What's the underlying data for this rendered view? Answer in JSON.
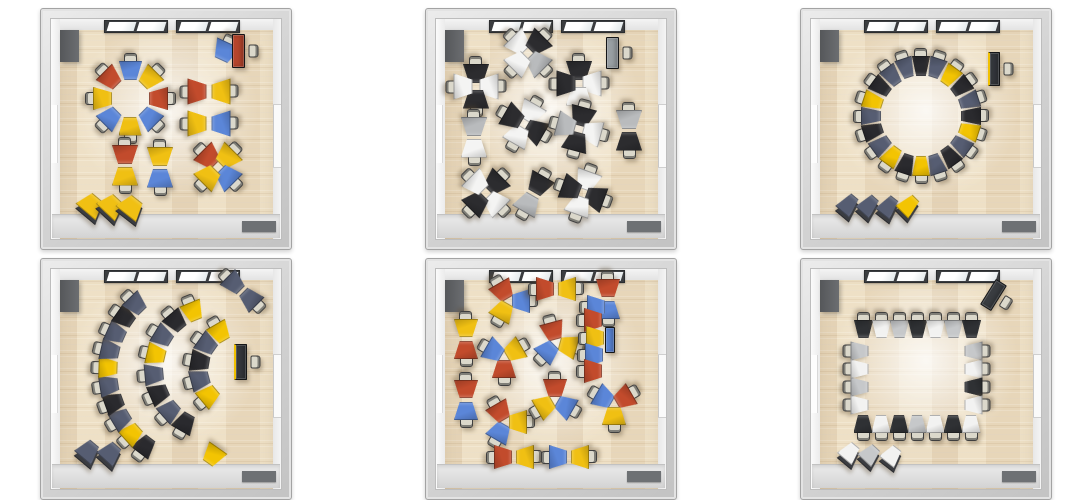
{
  "theme": {
    "floor_wood": "#ecdfc6",
    "wall_gray": "#d2d2d2",
    "walkway_gray": "#dedede",
    "door_mat_gray": "#6e7174",
    "window_frame": "#3b3d40",
    "chair_seat": "#dbd8cb"
  },
  "rooms": [
    {
      "name": "ring-and-groups-color",
      "palette": [
        "#c24b2c",
        "#f0c013",
        "#5b86d8"
      ],
      "tw": 26,
      "th": 19,
      "groups": [
        {
          "t": "ring",
          "cx": 89,
          "cy": 89,
          "r": 28,
          "start": 0,
          "tw": 23,
          "colors": [
            2,
            1,
            0,
            2,
            1,
            2,
            1,
            0
          ]
        },
        {
          "t": "single",
          "x": 184,
          "y": 42,
          "rot": 205,
          "c": 2,
          "chair": true
        },
        {
          "t": "desk",
          "x": 197,
          "y": 42,
          "w": 13,
          "h": 34,
          "rot": 0,
          "color": "#b5452c",
          "chair": true
        },
        {
          "t": "cluster",
          "cx": 168,
          "cy": 82,
          "r": 12,
          "angles": [
            270,
            90
          ],
          "colors": [
            0,
            1
          ]
        },
        {
          "t": "cluster",
          "cx": 168,
          "cy": 114,
          "r": 12,
          "angles": [
            270,
            90
          ],
          "colors": [
            1,
            2
          ]
        },
        {
          "t": "cluster",
          "cx": 84,
          "cy": 156,
          "r": 11,
          "angles": [
            0,
            180
          ],
          "colors": [
            0,
            1
          ]
        },
        {
          "t": "cluster",
          "cx": 119,
          "cy": 158,
          "r": 11,
          "angles": [
            0,
            180
          ],
          "colors": [
            1,
            2
          ]
        },
        {
          "t": "cluster",
          "cx": 177,
          "cy": 158,
          "r": 13,
          "angles": [
            315,
            45,
            135,
            225
          ],
          "colors": [
            0,
            1,
            2,
            1
          ]
        },
        {
          "t": "stack",
          "x": 48,
          "y": 196,
          "rot": 40,
          "c": 1
        },
        {
          "t": "stack",
          "x": 68,
          "y": 197,
          "rot": 43,
          "c": 1
        },
        {
          "t": "stack",
          "x": 88,
          "y": 198,
          "rot": 38,
          "c": 1
        }
      ]
    },
    {
      "name": "scattered-pods-monochrome",
      "palette": [
        "#2c2c2f",
        "#f4f4f3",
        "#b9bbbd"
      ],
      "tw": 26,
      "th": 19,
      "groups": [
        {
          "t": "cluster",
          "cx": 102,
          "cy": 44,
          "r": 13,
          "angles": [
            315,
            45,
            135,
            225
          ],
          "colors": [
            1,
            0,
            2,
            1
          ]
        },
        {
          "t": "cluster",
          "cx": 50,
          "cy": 77,
          "r": 13,
          "angles": [
            0,
            90,
            180,
            270
          ],
          "colors": [
            0,
            1,
            0,
            1
          ]
        },
        {
          "t": "cluster",
          "cx": 153,
          "cy": 74,
          "r": 13,
          "angles": [
            0,
            90,
            180,
            270
          ],
          "colors": [
            0,
            1,
            1,
            0
          ]
        },
        {
          "t": "desk",
          "x": 186,
          "y": 44,
          "w": 13,
          "h": 32,
          "rot": 0,
          "color": "#9aa0a4",
          "chair": true
        },
        {
          "t": "cluster",
          "cx": 48,
          "cy": 128,
          "r": 11,
          "angles": [
            0,
            180
          ],
          "colors": [
            2,
            1
          ]
        },
        {
          "t": "cluster",
          "cx": 98,
          "cy": 115,
          "r": 13,
          "angles": [
            30,
            120,
            210,
            300
          ],
          "colors": [
            1,
            0,
            1,
            0
          ]
        },
        {
          "t": "cluster",
          "cx": 153,
          "cy": 120,
          "r": 13,
          "angles": [
            15,
            105,
            195,
            285
          ],
          "colors": [
            0,
            1,
            0,
            2
          ]
        },
        {
          "t": "cluster",
          "cx": 203,
          "cy": 121,
          "r": 11,
          "angles": [
            0,
            180
          ],
          "colors": [
            2,
            0
          ]
        },
        {
          "t": "cluster",
          "cx": 60,
          "cy": 184,
          "r": 13,
          "angles": [
            45,
            135,
            225,
            315
          ],
          "colors": [
            0,
            1,
            0,
            1
          ]
        },
        {
          "t": "cluster",
          "cx": 107,
          "cy": 185,
          "r": 11,
          "angles": [
            30,
            210
          ],
          "colors": [
            0,
            2
          ]
        },
        {
          "t": "cluster",
          "cx": 157,
          "cy": 184,
          "r": 13,
          "angles": [
            20,
            110,
            200,
            290
          ],
          "colors": [
            1,
            0,
            1,
            0
          ]
        }
      ]
    },
    {
      "name": "circle-monochrome-yellow",
      "palette": [
        "#565d72",
        "#2a2a2e",
        "#f3c402"
      ],
      "tw": 18,
      "th": 20,
      "groups": [
        {
          "t": "ring",
          "cx": 120,
          "cy": 107,
          "r": 50,
          "start": 0,
          "colors": [
            1,
            0,
            2,
            1,
            0,
            1,
            2,
            0,
            1,
            0,
            2,
            1,
            2,
            0,
            1,
            0,
            2,
            1,
            0,
            0
          ]
        },
        {
          "t": "desk",
          "x": 193,
          "y": 60,
          "w": 12,
          "h": 34,
          "rot": 0,
          "color": "#34373c",
          "accent": "#f0c000",
          "chair": true
        },
        {
          "t": "stack",
          "x": 45,
          "y": 196,
          "rot": 40,
          "c": 0
        },
        {
          "t": "stack",
          "x": 65,
          "y": 197,
          "rot": 42,
          "c": 0
        },
        {
          "t": "stack",
          "x": 85,
          "y": 198,
          "rot": 38,
          "c": 0
        },
        {
          "t": "stack",
          "x": 105,
          "y": 197,
          "rot": 45,
          "c": 2
        }
      ]
    },
    {
      "name": "amphitheater-arcs",
      "palette": [
        "#565d72",
        "#2a2a2e",
        "#f3c402"
      ],
      "tw": 22,
      "th": 19,
      "groups": [
        {
          "t": "arc",
          "cx": 160,
          "cy": 112,
          "r": 93,
          "a1": 217,
          "a2": 316,
          "colors": [
            1,
            2,
            0,
            1,
            0,
            2,
            0,
            0,
            1,
            0
          ]
        },
        {
          "t": "arc",
          "cx": 175,
          "cy": 110,
          "r": 62,
          "a1": 210,
          "a2": 338,
          "colors": [
            1,
            0,
            1,
            0,
            2,
            0,
            1,
            2
          ]
        },
        {
          "t": "arc",
          "cx": 200,
          "cy": 110,
          "r": 42,
          "a1": 230,
          "a2": 330,
          "colors": [
            2,
            0,
            1,
            0,
            2
          ]
        },
        {
          "t": "desk",
          "x": 199,
          "y": 103,
          "w": 13,
          "h": 36,
          "rot": 0,
          "color": "#34373c",
          "accent": "#f0c000",
          "chair": true
        },
        {
          "t": "cluster",
          "cx": 201,
          "cy": 32,
          "r": 11,
          "angles": [
            135,
            315
          ],
          "colors": [
            0,
            0
          ]
        },
        {
          "t": "stack",
          "x": 45,
          "y": 192,
          "rot": 40,
          "c": 0
        },
        {
          "t": "stack",
          "x": 67,
          "y": 194,
          "rot": 42,
          "c": 0
        },
        {
          "t": "single",
          "x": 172,
          "y": 196,
          "rot": 215,
          "c": 2,
          "chair": false
        }
      ]
    },
    {
      "name": "scattered-pods-color",
      "palette": [
        "#c24b2c",
        "#f0c013",
        "#5b86d8"
      ],
      "tw": 24,
      "th": 18,
      "groups": [
        {
          "t": "cluster",
          "cx": 83,
          "cy": 42,
          "r": 12,
          "angles": [
            330,
            90,
            210
          ],
          "colors": [
            0,
            2,
            1
          ]
        },
        {
          "t": "cluster",
          "cx": 130,
          "cy": 30,
          "r": 11,
          "angles": [
            270,
            90
          ],
          "colors": [
            0,
            1
          ]
        },
        {
          "t": "cluster",
          "cx": 182,
          "cy": 40,
          "r": 11,
          "angles": [
            0,
            180
          ],
          "colors": [
            0,
            2
          ]
        },
        {
          "t": "cluster",
          "cx": 40,
          "cy": 80,
          "r": 11,
          "angles": [
            0,
            180
          ],
          "colors": [
            1,
            0
          ]
        },
        {
          "t": "cluster",
          "cx": 78,
          "cy": 98,
          "r": 12,
          "angles": [
            60,
            180,
            300
          ],
          "colors": [
            1,
            0,
            2
          ]
        },
        {
          "t": "cluster",
          "cx": 130,
          "cy": 84,
          "r": 12,
          "angles": [
            345,
            105,
            225
          ],
          "colors": [
            0,
            1,
            2
          ]
        },
        {
          "t": "single",
          "x": 170,
          "y": 48,
          "rot": 90,
          "c": 2,
          "chair": true
        },
        {
          "t": "single",
          "x": 167,
          "y": 61,
          "rot": 90,
          "c": 0,
          "chair": true
        },
        {
          "t": "single",
          "x": 169,
          "y": 79,
          "rot": 90,
          "c": 1,
          "chair": true
        },
        {
          "t": "single",
          "x": 168,
          "y": 96,
          "rot": 90,
          "c": 2,
          "chair": true
        },
        {
          "t": "single",
          "x": 167,
          "y": 112,
          "rot": 90,
          "c": 0,
          "chair": true
        },
        {
          "t": "desk",
          "x": 184,
          "y": 81,
          "w": 10,
          "h": 26,
          "rot": 0,
          "color": "#5b86d8",
          "chair": false
        },
        {
          "t": "cluster",
          "cx": 40,
          "cy": 141,
          "r": 11,
          "angles": [
            0,
            180
          ],
          "colors": [
            0,
            2
          ]
        },
        {
          "t": "cluster",
          "cx": 80,
          "cy": 163,
          "r": 12,
          "angles": [
            210,
            330,
            90
          ],
          "colors": [
            2,
            0,
            1
          ]
        },
        {
          "t": "cluster",
          "cx": 129,
          "cy": 141,
          "r": 12,
          "angles": [
            0,
            120,
            240
          ],
          "colors": [
            0,
            2,
            1
          ]
        },
        {
          "t": "cluster",
          "cx": 188,
          "cy": 145,
          "r": 12,
          "angles": [
            300,
            60,
            180
          ],
          "colors": [
            2,
            0,
            1
          ]
        },
        {
          "t": "cluster",
          "cx": 88,
          "cy": 198,
          "r": 11,
          "angles": [
            270,
            90
          ],
          "colors": [
            0,
            1
          ]
        },
        {
          "t": "cluster",
          "cx": 143,
          "cy": 198,
          "r": 11,
          "angles": [
            270,
            90
          ],
          "colors": [
            2,
            1
          ]
        }
      ]
    },
    {
      "name": "hollow-square-monochrome",
      "palette": [
        "#2f3134",
        "#f2f2f1",
        "#c6c8ca"
      ],
      "tw": 19,
      "th": 18,
      "groups": [
        {
          "t": "row",
          "x": 62,
          "y": 70,
          "dx": 18,
          "dy": 0,
          "rot": 180,
          "colors": [
            0,
            1,
            2,
            0,
            1,
            2,
            0
          ]
        },
        {
          "t": "row",
          "x": 172,
          "y": 92,
          "dx": 0,
          "dy": 18,
          "rot": 270,
          "colors": [
            2,
            1,
            0,
            1
          ]
        },
        {
          "t": "row",
          "x": 62,
          "y": 165,
          "dx": 18,
          "dy": 0,
          "rot": 0,
          "colors": [
            0,
            1,
            0,
            2,
            1,
            0,
            1
          ]
        },
        {
          "t": "row",
          "x": 58,
          "y": 92,
          "dx": 0,
          "dy": 18,
          "rot": 90,
          "colors": [
            2,
            1,
            2,
            1
          ]
        },
        {
          "t": "desk",
          "x": 192,
          "y": 36,
          "w": 13,
          "h": 30,
          "rot": 32,
          "color": "#3a3d41",
          "chair": true
        },
        {
          "t": "stack",
          "x": 46,
          "y": 194,
          "rot": 40,
          "c": 1
        },
        {
          "t": "stack",
          "x": 66,
          "y": 196,
          "rot": 43,
          "c": 2
        },
        {
          "t": "stack",
          "x": 88,
          "y": 197,
          "rot": 38,
          "c": 1
        }
      ]
    }
  ]
}
